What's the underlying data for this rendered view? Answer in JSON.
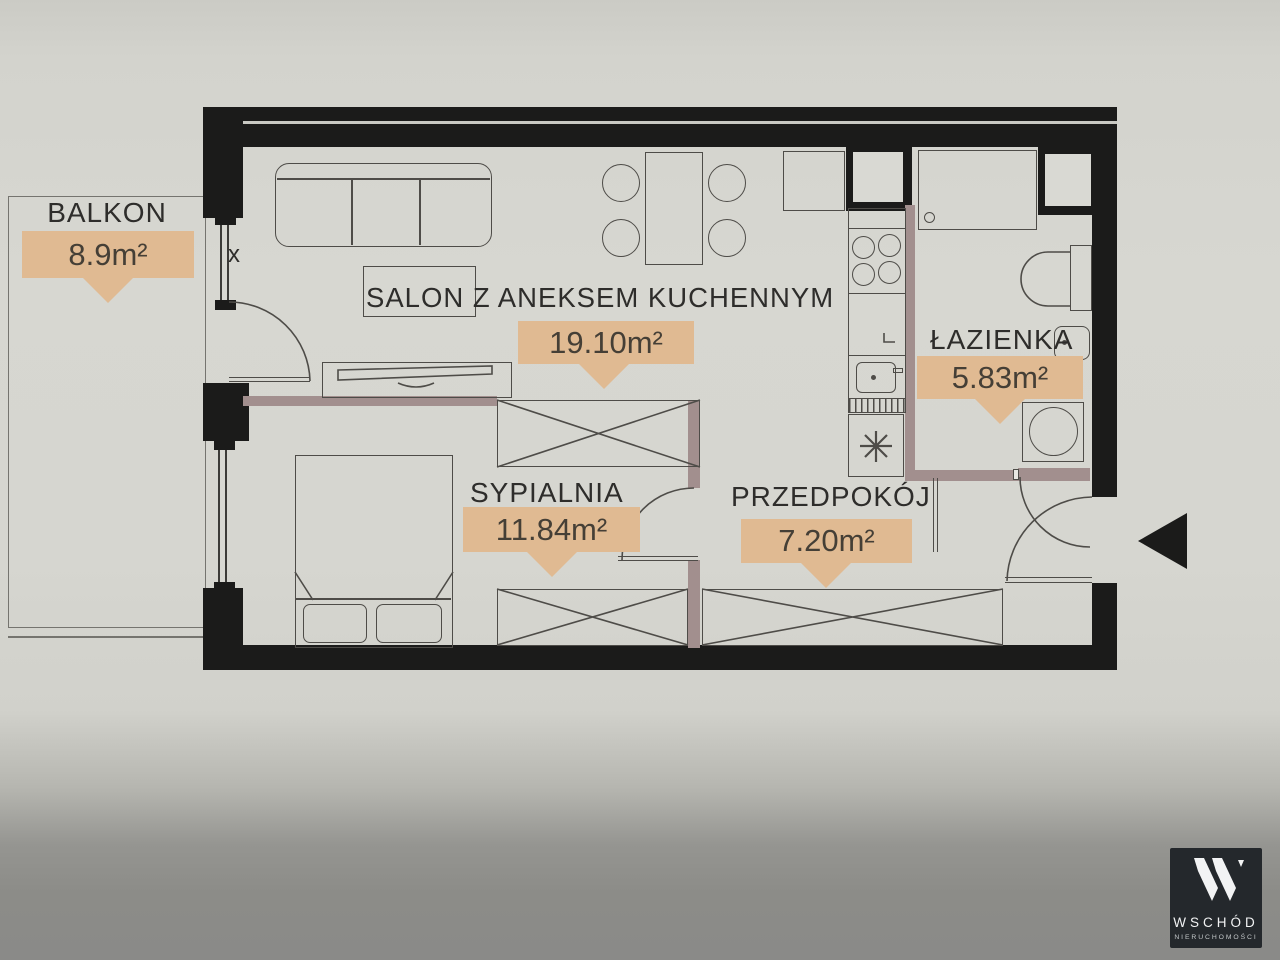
{
  "colors": {
    "wall": "#1b1b1a",
    "partition": "#a28f8e",
    "accent": "#e0ba92",
    "line": "#4e4c48",
    "label": "#2e2d2b",
    "logo-bg": "#24282c"
  },
  "floorplan": {
    "rooms": [
      {
        "id": "balkon",
        "name": "BALKON",
        "area": "8.9m²"
      },
      {
        "id": "salon",
        "name": "SALON Z ANEKSEM KUCHENNYM",
        "area": "19.10m²"
      },
      {
        "id": "lazienka",
        "name": "ŁAZIENKA",
        "area": "5.83m²"
      },
      {
        "id": "sypialnia",
        "name": "SYPIALNIA",
        "area": "11.84m²"
      },
      {
        "id": "przedpokoj",
        "name": "PRZEDPOKÓJ",
        "area": "7.20m²"
      }
    ],
    "window_mark": "x"
  },
  "branding": {
    "logo_title": "WSCHÓD",
    "logo_subtitle": "NIERUCHOMOŚCI",
    "logo_icon": "wschod-w-monogram"
  }
}
